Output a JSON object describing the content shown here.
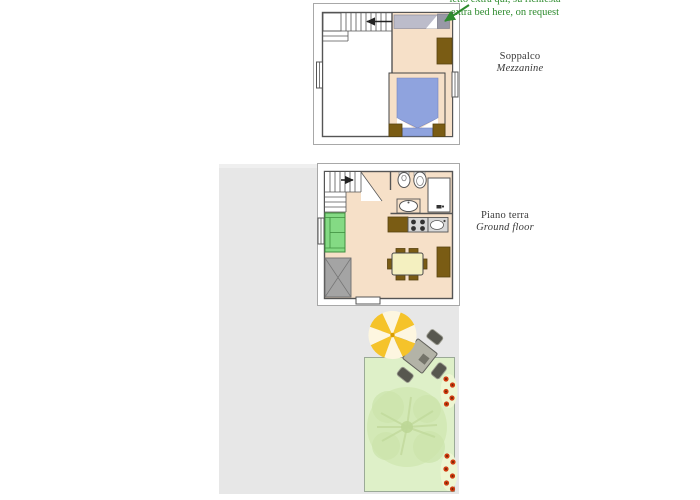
{
  "annotation": {
    "line1": "letto extra qui, su richiesta",
    "line2": "extra bed here, on request"
  },
  "labels": {
    "mezzanine_it": "Soppalco",
    "mezzanine_en": "Mezzanine",
    "ground_it": "Piano terra",
    "ground_en": "Ground floor"
  },
  "floors": [
    {
      "name": "Soppalco / Mezzanine",
      "features": [
        "staircase-down",
        "extra-bed-spot",
        "double-bed",
        "nightstands",
        "wardrobe",
        "window-left",
        "window-right"
      ]
    },
    {
      "name": "Piano terra / Ground floor",
      "features": [
        "staircase-up",
        "bathroom-with-toilet-bidet-washbasin-shower",
        "kitchenette-with-hob-and-sink",
        "sofa",
        "dining-table-six-chairs",
        "wardrobe",
        "entrance-door",
        "window-left"
      ]
    }
  ],
  "outdoor": {
    "features": [
      "paved-terrace",
      "parasol",
      "garden-table-four-chairs",
      "lawn-garden",
      "tree",
      "red-flower-borders"
    ]
  },
  "colors": {
    "floor": "#f6e0c8",
    "wall": "#555555",
    "frame": "#a8a8a8",
    "bed_blue": "#8fa3de",
    "furniture_brown": "#7a5c14",
    "sofa_green": "#84da84",
    "sofa_green_dark": "#3f8f3f",
    "terrace_gray": "#e7e7e7",
    "garden_green": "#def0c8",
    "tree_green": "#cfe6ad",
    "umbrella_yellow": "#f5c32a",
    "umbrella_cream": "#fdf6e0",
    "flower_red": "#cf3a10",
    "annotation_green": "#2e8b2e",
    "label_text": "#3a3a3a",
    "table_cream": "#f4f0c0",
    "gray_unit": "#d8d8d8",
    "entry_gray": "#a4a4a4",
    "extra_bed_gray": "#bcbcca"
  }
}
